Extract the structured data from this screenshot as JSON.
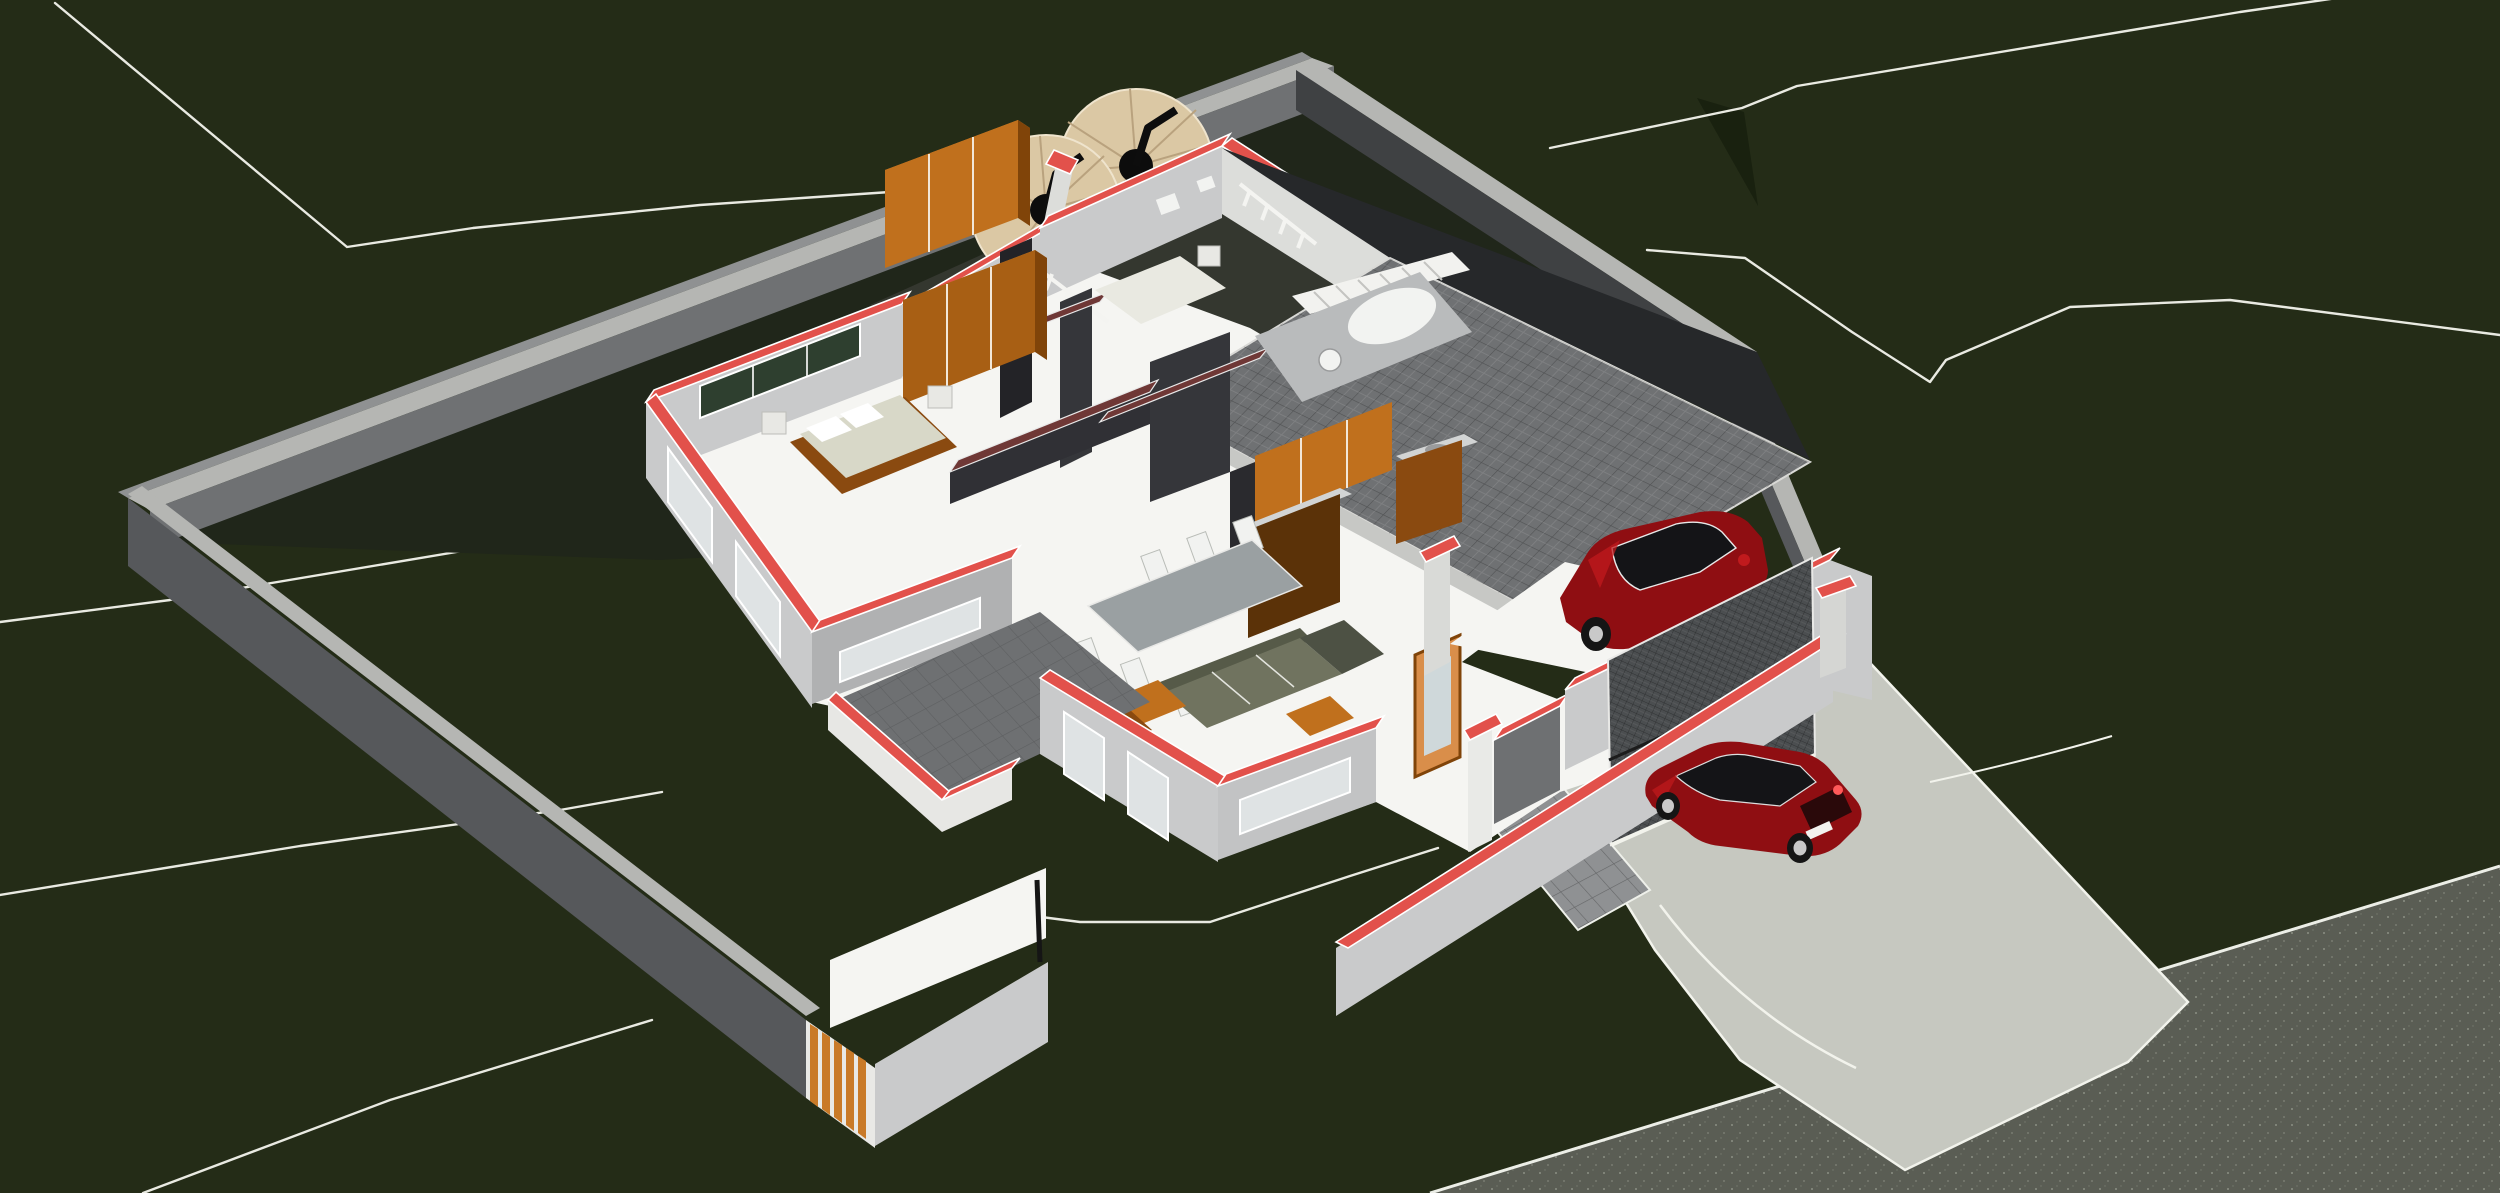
{
  "meta": {
    "title": "Aerial 3D cutaway render of a walled residential house plot",
    "view": "perspective section view, horizontal cut through walls marked red"
  },
  "palette": {
    "bg": "#242c17",
    "lawnDeep": "#1f2713",
    "contour": "#e9eae2",
    "crease": "#19210f",
    "shadowBand": "#20261a",
    "tankYardShadow": "#34372f",
    "wallCap": "#b5b6b3",
    "wallOuterLight": "#8f9192",
    "wallInnerLit": "#6f7173",
    "wallInnerDark": "#3f4143",
    "wallFaceFront": "#56585b",
    "cutRed": "#e2514b",
    "cutMaroon": "#6f3836",
    "houseWallLight": "#c9cacb",
    "houseWallLighter": "#dcddda",
    "houseWallMid": "#b0b1b2",
    "houseWallDark": "#6e7072",
    "charcoal": "#232327",
    "charcoal2": "#35363a",
    "floorWhite": "#f5f5f2",
    "glass": "#dfe3e4",
    "glassGreen": "#2e3f2f",
    "pillarWhite": "#e9eae7",
    "timberFace": "#c0701d",
    "timberSide": "#804409",
    "timberTop": "#d08a34",
    "gateSlat": "#c97a28",
    "cabinetDark": "#5b3208",
    "counterSteel": "#d2d4d4",
    "bedPlatform": "#8a4a10",
    "mattress": "#d8d8c8",
    "sofaBody": "#70735f",
    "sofaBack": "#565a48",
    "sofaChaise": "#4d5144",
    "tableTop": "#9aa0a2",
    "chairWhite": "#f1f2f0",
    "bathPlatform": "#b9bbbc",
    "fixtureWhite": "#f2f3f1",
    "roofTile": "#6f7173",
    "roofDark": "#26282a",
    "roofFascia": "#c7c8c5",
    "stairWhite": "#f2f2ef",
    "paver": "#8f9193",
    "concrete": "#c6c8c0",
    "asphalt": "#5a5d54",
    "doorTimber": "#d98e4a",
    "doorGlass": "#cfd8da",
    "garageDoor": "#4b4e50",
    "carBody": "#8f0e12",
    "carHighlight": "#c01a1d",
    "carShadow": "#3f0507",
    "carGlass": "#141417",
    "wheelDark": "#151515",
    "wheelRim": "#c9c9c9"
  },
  "scene": {
    "site": {
      "ground": "dark olive terrain with surveyed contour polylines",
      "boundary_wall": "grey masonry perimeter wall with light coping",
      "pedestrian_gate": "vertical timber slat gate in front wall",
      "driveway": "light concrete apron from garage across lawn",
      "road": "speckled asphalt road at lower right",
      "water_tanks": 2
    },
    "house": {
      "section": "walls cut horizontally; cut faces shown red (exterior) and maroon (interior)",
      "rooms": [
        "bedroom-1",
        "bedroom-2",
        "bathroom",
        "kitchen",
        "dining-area",
        "living-room",
        "entry-porch",
        "garage"
      ],
      "furniture": [
        "wardrobe-bedroom-2",
        "wardrobe-bedroom-1",
        "double-bed",
        "single-bed",
        "kitchen-upper-cabinets",
        "kitchen-island",
        "sink-unit",
        "dining-table",
        "dining-chairs",
        "l-shaped-sofa",
        "armchairs",
        "coffee-table",
        "bathtub",
        "wash-basin"
      ],
      "roof": "grey tiled flat roof over garage wing with dark membrane deck behind",
      "stairs": "white external stair and balustrades at roof edge"
    },
    "vehicles": [
      {
        "type": "suv",
        "color": "dark red",
        "location": "inside garage"
      },
      {
        "type": "hatchback",
        "color": "dark red",
        "location": "on driveway"
      }
    ]
  }
}
